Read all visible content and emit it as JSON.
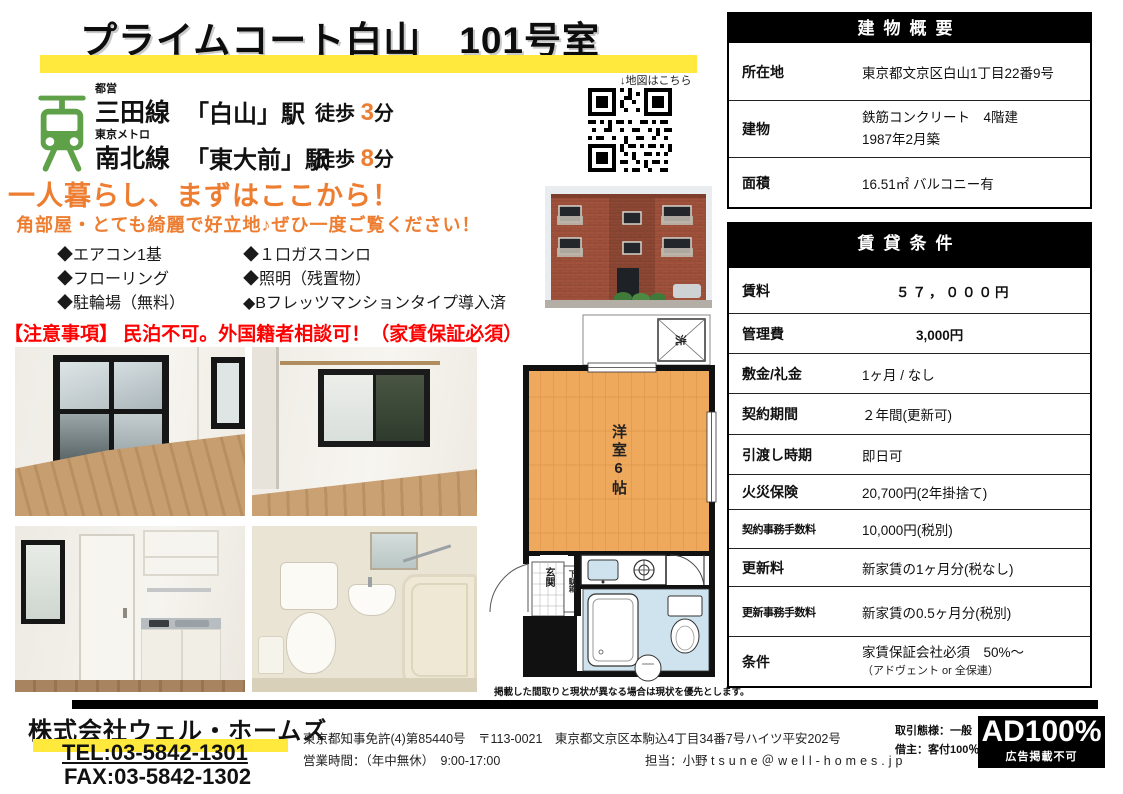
{
  "colors": {
    "accent_orange": "#ed7d31",
    "highlight_yellow": "#ffe93c",
    "alert_red": "#ff0000",
    "line_green": "#5ea149"
  },
  "header": {
    "title": "プライムコート白山　101号室",
    "map_note": "↓地図はこちら"
  },
  "access": {
    "lines": [
      {
        "operator": "都営",
        "line": "三田線",
        "station": "「白山」駅",
        "walk": "徒歩",
        "minutes": "3",
        "unit": "分"
      },
      {
        "operator": "東京メトロ",
        "line": "南北線",
        "station": "「東大前」駅",
        "walk": "徒歩",
        "minutes": "8",
        "unit": "分"
      }
    ]
  },
  "catch": {
    "headline": "一人暮らし、まずはここから！",
    "subline": "角部屋・とても綺麗で好立地♪ぜひ一度ご覧ください！"
  },
  "features": {
    "col1": [
      "◆エアコン1基",
      "◆フローリング",
      "◆駐輪場（無料）"
    ],
    "col2": [
      "◆１口ガスコンロ",
      "◆照明（残置物）",
      "◆Bフレッツマンションタイプ導入済"
    ]
  },
  "caution": "【注意事項】 民泊不可。外国籍者相談可！（家賃保証必須）",
  "building_overview": {
    "title": "建物概要",
    "rows": [
      {
        "label": "所在地",
        "value": "東京都文京区白山1丁目22番9号"
      },
      {
        "label": "建物",
        "value": "鉄筋コンクリート　4階建",
        "value2": "1987年2月築"
      },
      {
        "label": "面積",
        "value": "16.51㎡ バルコニー有"
      }
    ]
  },
  "rental_terms": {
    "title": "賃貸条件",
    "rows": [
      {
        "label": "賃料",
        "value": "５７，０００円"
      },
      {
        "label": "管理費",
        "value": "3,000円"
      },
      {
        "label": "敷金/礼金",
        "value": "1ヶ月 / なし"
      },
      {
        "label": "契約期間",
        "value": "２年間(更新可)"
      },
      {
        "label": "引渡し時期",
        "value": "即日可"
      },
      {
        "label": "火災保険",
        "value": "20,700円(2年掛捨て)"
      },
      {
        "label": "契約事務手数料",
        "value": "10,000円(税別)"
      },
      {
        "label": "更新料",
        "value": "新家賃の1ヶ月分(税なし)"
      },
      {
        "label": "更新事務手数料",
        "value": "新家賃の0.5ヶ月分(税別)"
      },
      {
        "label": "条件",
        "value": "家賃保証会社必須　50%～",
        "value2": "（アドヴェント or 全保連）"
      }
    ]
  },
  "floor_plan": {
    "room_label": "洋室6帖",
    "washer": "洗",
    "entrance": "玄関",
    "shoe_box": "下駄箱",
    "note": "掲載した間取りと現状が異なる場合は現状を優先とします。"
  },
  "footer": {
    "company": "株式会社ウェル・ホームズ",
    "tel": "TEL:03-5842-1301",
    "fax": "FAX:03-5842-1302",
    "license": "東京都知事免許(4)第85440号　〒113-0021　東京都文京区本駒込4丁目34番7号ハイツ平安202号",
    "hours": "営業時間：（年中無休）　9:00-17:00",
    "contact": "担当：小野",
    "email": "tsune＠well-homes.jp",
    "deal_type": "取引態様：一般",
    "deal_note": "借主：客付100％",
    "ad_badge": "AD100%",
    "ad_note": "広告掲載不可"
  }
}
